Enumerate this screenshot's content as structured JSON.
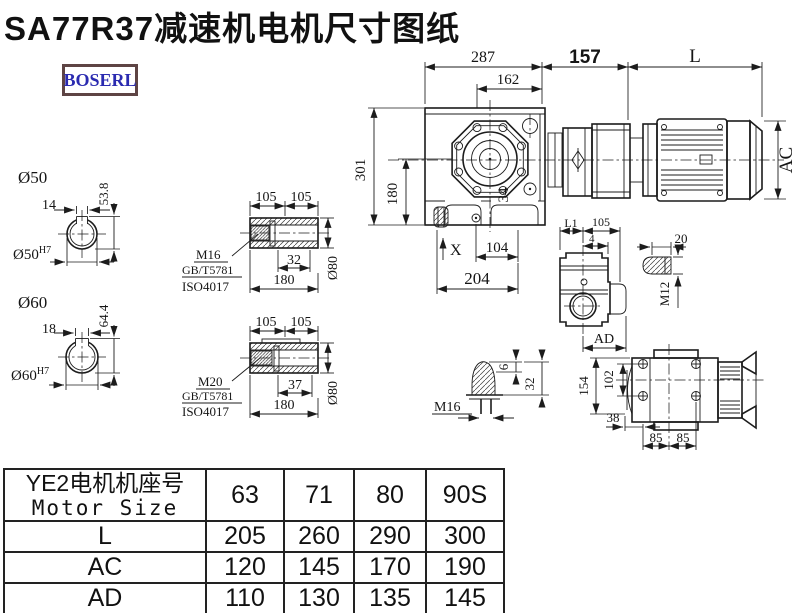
{
  "title": "SA77R37减速机电机尺寸图纸",
  "logo": {
    "text": "BOSERL"
  },
  "colors": {
    "ink": "#1c1c1c",
    "logo_text": "#2a2ab0",
    "logo_border": "#5e4444"
  },
  "main_view": {
    "dim_top_total": "287",
    "dim_top_inner": "162",
    "dim_adapter": "157",
    "dim_motor_length": "L",
    "dim_height": "301",
    "dim_axis_height": "180",
    "dim_foot_x": "X",
    "dim_foot_inner": "104",
    "dim_foot_total": "204",
    "dim_side_34": "34",
    "dim_motor_dia": "AC"
  },
  "bore_detail_top": {
    "label": "Ø50",
    "keyway_width": "14",
    "keyway_height": "53.8",
    "bore_fit": "Ø50",
    "bore_fit_sup": "H7"
  },
  "bore_detail_bottom": {
    "label": "Ø60",
    "keyway_width": "18",
    "keyway_height": "64.4",
    "bore_fit": "Ø60",
    "bore_fit_sup": "H7"
  },
  "hollow_shaft_top": {
    "dim_left": "105",
    "dim_right": "105",
    "thread": "M16",
    "standard1": "GB/T5781",
    "standard2": "ISO4017",
    "dim_thread_len": "32",
    "dim_total": "180",
    "dim_dia": "Ø80"
  },
  "hollow_shaft_bottom": {
    "dim_left": "105",
    "dim_right": "105",
    "thread": "M20",
    "standard1": "GB/T5781",
    "standard2": "ISO4017",
    "dim_thread_len": "37",
    "dim_total": "180",
    "dim_dia": "Ø80"
  },
  "side_view": {
    "dim_l1": "L1",
    "dim_105": "105",
    "dim_4": "4",
    "dim_ad": "AD"
  },
  "plug_detail": {
    "dim_20": "20",
    "thread": "M12"
  },
  "vent_detail": {
    "dim_6": "6",
    "dim_32": "32",
    "thread": "M16"
  },
  "rear_view": {
    "dim_154": "154",
    "dim_102": "102",
    "dim_38": "38",
    "dim_85_left": "85",
    "dim_85_right": "85"
  },
  "table": {
    "header_line1": "YE2电机机座号",
    "header_line2": "Motor Size",
    "columns": [
      "63",
      "71",
      "80",
      "90S"
    ],
    "rows": [
      {
        "label": "L",
        "values": [
          "205",
          "260",
          "290",
          "300"
        ]
      },
      {
        "label": "AC",
        "values": [
          "120",
          "145",
          "170",
          "190"
        ]
      },
      {
        "label": "AD",
        "values": [
          "110",
          "130",
          "135",
          "145"
        ]
      }
    ]
  }
}
